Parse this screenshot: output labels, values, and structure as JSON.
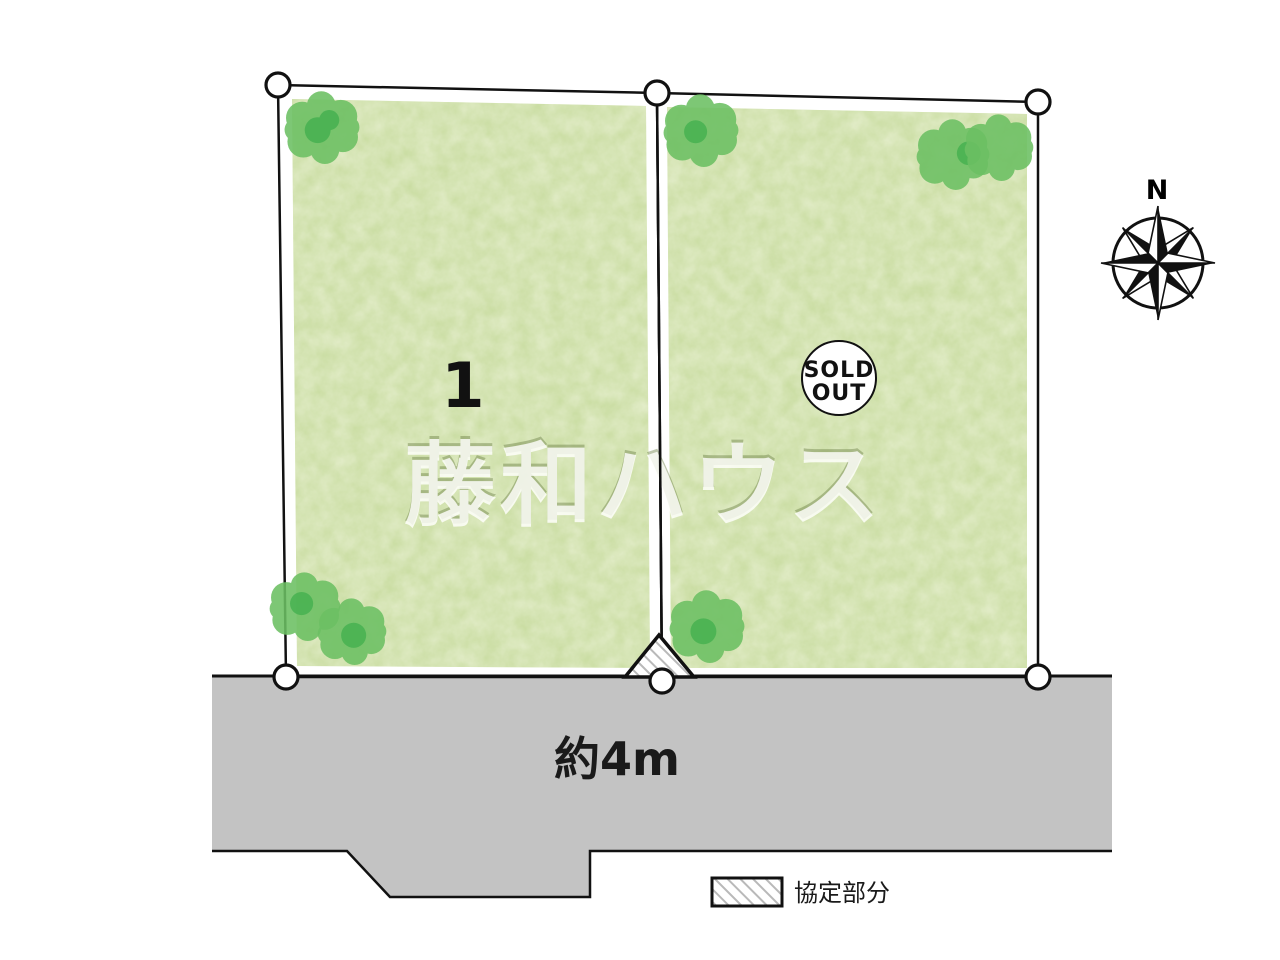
{
  "diagram": {
    "plot1": {
      "number": "1"
    },
    "plot2": {
      "sold_out_line1": "SOLD",
      "sold_out_line2": "OUT"
    },
    "road": {
      "width_label": "約4m"
    },
    "legend": {
      "label": "協定部分"
    },
    "compass": {
      "north": "N"
    },
    "watermark": "藤和ハウス"
  },
  "colors": {
    "plot_green": "#c7db9e",
    "tree_green": "#6cc063",
    "tree_dark": "#43b04f",
    "road_gray": "#c3c3c3",
    "hatch_gray": "#b9b9b9",
    "outline_black": "#111111"
  }
}
